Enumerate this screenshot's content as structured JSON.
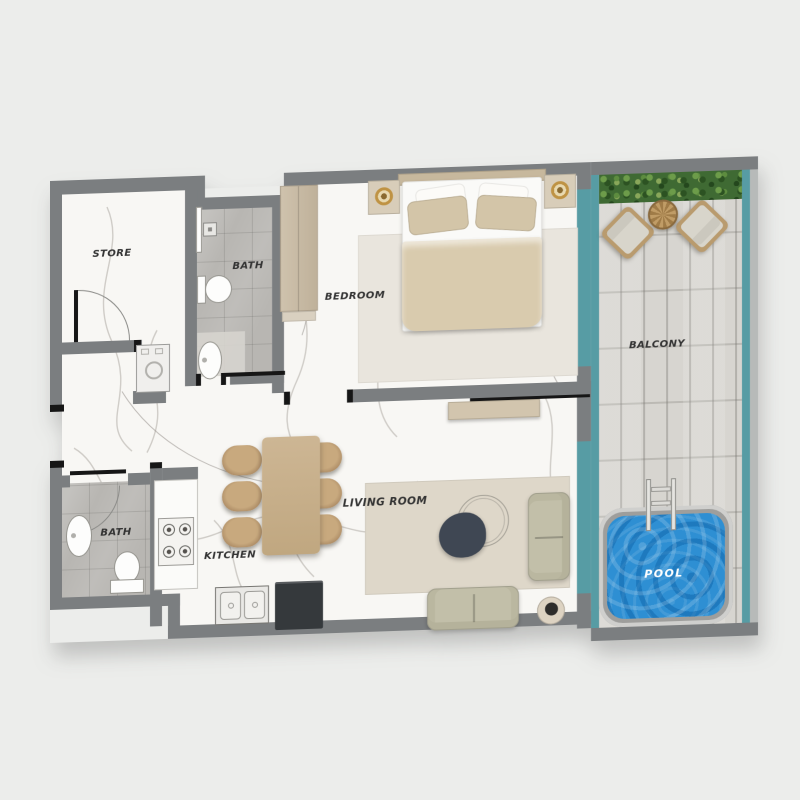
{
  "plan": {
    "type": "apartment-floor-plan",
    "rooms": {
      "store": {
        "label": "STORE"
      },
      "bath_top": {
        "label": "BATH"
      },
      "bedroom": {
        "label": "BEDROOM"
      },
      "balcony": {
        "label": "BALCONY"
      },
      "bath_lower": {
        "label": "BATH"
      },
      "kitchen": {
        "label": "KITCHEN"
      },
      "living": {
        "label": "LIVING ROOM"
      },
      "pool": {
        "label": "POOL"
      }
    },
    "colors": {
      "bg": "#ecedeb",
      "wall": "#7b7e80",
      "glass": "#579ca4",
      "deck": "#d7d5d0",
      "water": "#2e8fd3",
      "pooledge": "#9e9e9c",
      "marble": "#f8f7f4",
      "tile": "#b8b6b2",
      "hedge": "#3f6a33",
      "wood": "#c6ad89",
      "wood2": "#c7b89d",
      "sofa": "#c2bfa9",
      "duvet": "#d9cbae",
      "pillow": "#d3c5a8",
      "rug1": "#e9e5dd",
      "rug2": "#ded7c9",
      "tabledark": "#3f4753",
      "appliance": "#35393c",
      "label": "#333333",
      "lamp": "#bf9344",
      "fixture": "#fdfdfc"
    }
  }
}
